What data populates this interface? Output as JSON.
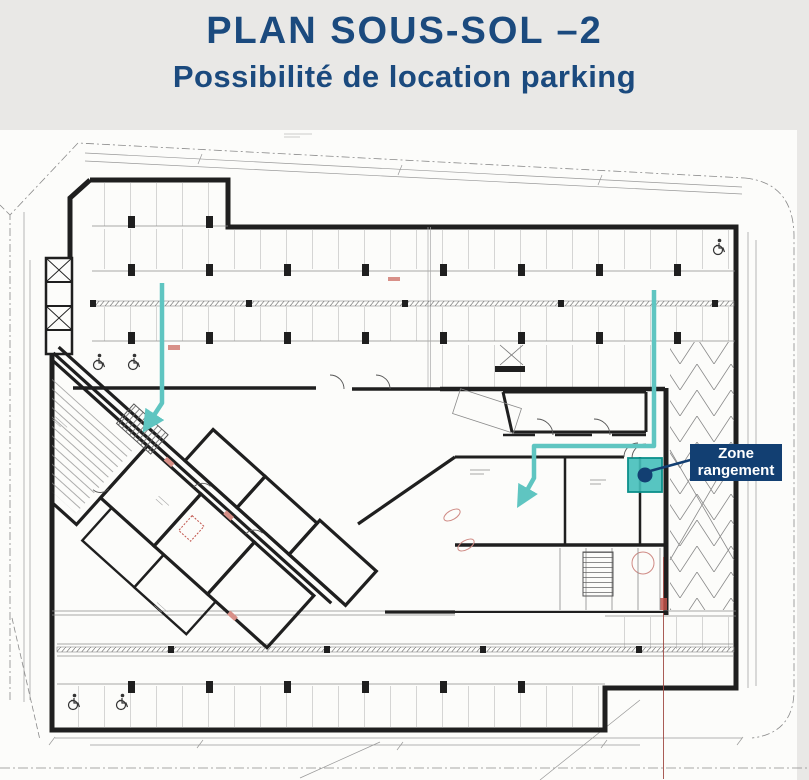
{
  "header": {
    "title": "PLAN SOUS-SOL –2",
    "subtitle": "Possibilité de location parking"
  },
  "callout": {
    "line1": "Zone",
    "line2": "rangement"
  },
  "colors": {
    "title_text": "#1b4a7e",
    "callout_background": "#123f72",
    "callout_text": "#ffffff",
    "highlight_teal_path": "#5fc5c1",
    "highlight_room_fill": "#45bfba",
    "highlight_room_border": "#0c8f8a",
    "marker_dot": "#123f72",
    "wall": "#1f1f1f",
    "detail_lines": "#8a8a8a",
    "accent_red": "#c0524a",
    "page_background": "#e9e8e6",
    "sheet_background": "#fcfcfa"
  },
  "icons": [
    {
      "name": "wheelchair-icon",
      "meaning": "accessible parking space",
      "count": 5
    },
    {
      "name": "arrow-down-left-icon",
      "meaning": "access path to storage",
      "count": 2
    }
  ],
  "plan": {
    "floor": "Sous-sol -2",
    "highlighted_zone": "Zone rangement"
  }
}
